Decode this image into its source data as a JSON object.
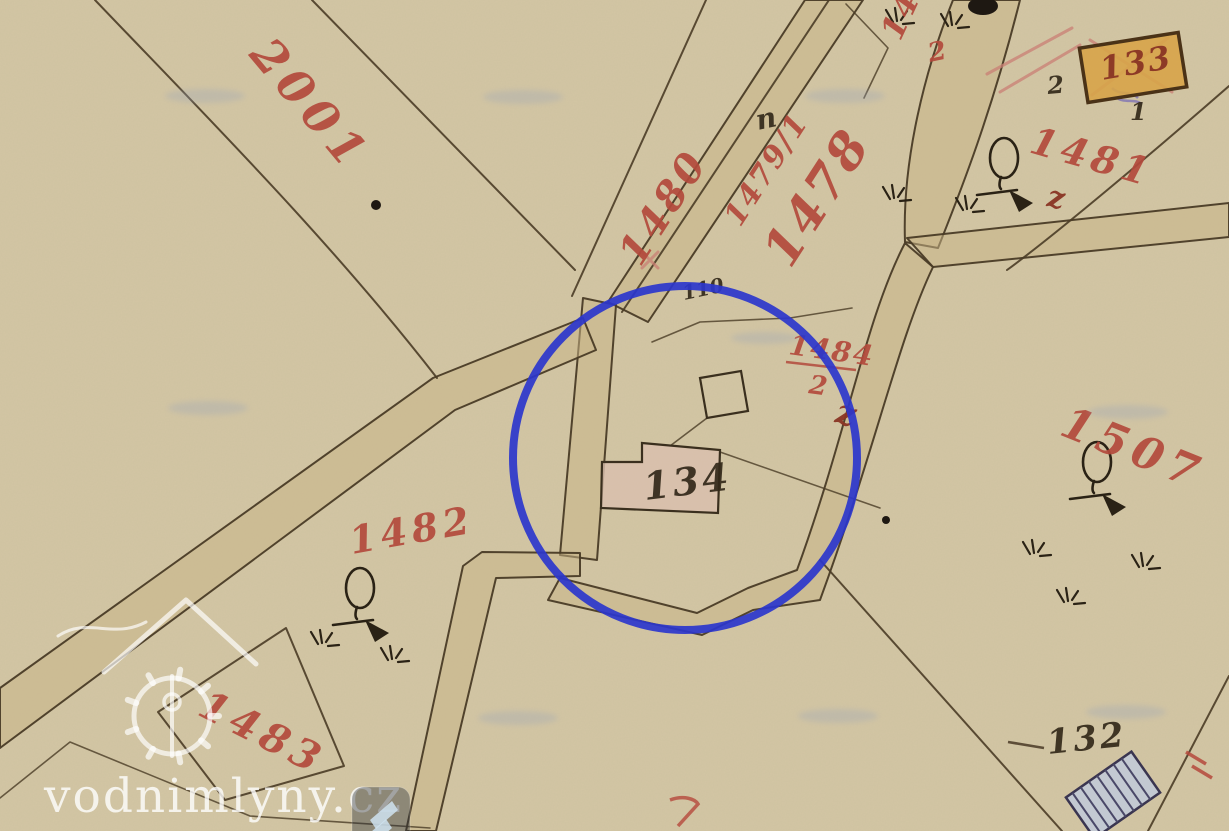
{
  "title": "Historical cadastral map scan with highlighted water-mill parcel",
  "watermark": {
    "site": "vodnimlyny.cz"
  },
  "highlight": {
    "shape": "circle",
    "color": "#2b36cc",
    "around_building": "134"
  },
  "labels": {
    "p2001": "2001",
    "p1480": "1480",
    "p1479_1": "1479/1",
    "p1478": "1478",
    "p1479": "1479",
    "p1479_den": "2",
    "p1481": "1481",
    "p1481_note": "z",
    "p1484": "1484",
    "p1484_den": "2",
    "p1484_note": "z",
    "p1482": "1482",
    "p1483": "1483",
    "p1507": "1507",
    "b133": "133",
    "b134": "134",
    "n110": "110",
    "n132": "132",
    "n2": "2",
    "n1": "1",
    "road_mark": "n"
  },
  "colors": {
    "paper": "#d3c6a4",
    "road_fill": "#c9b586",
    "ink": "#4a3c26",
    "red_label": "#b34a3c",
    "dark_red_label": "#8a3524",
    "highlight_blue": "#2b36cc",
    "building_134_fill": "#d9bfae",
    "building_133_fill": "#d7a449",
    "hatched_building_fill": "#c3c9d2"
  },
  "map_symbols": [
    "deciduous-tree",
    "grass-tuft",
    "hatched-building",
    "boundary-dot",
    "red-boundary-ticks"
  ]
}
